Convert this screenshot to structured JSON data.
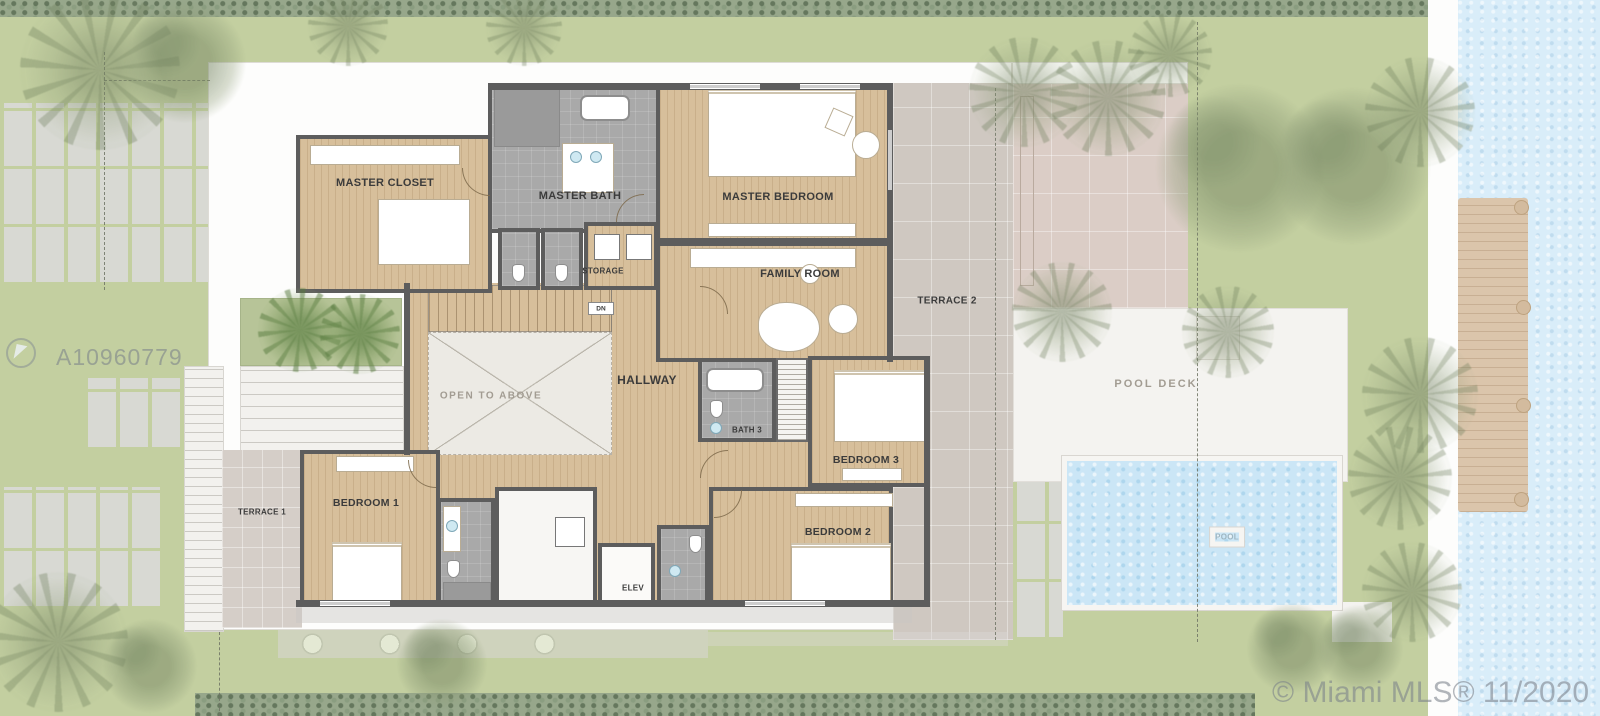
{
  "rooms": {
    "master_closet": "MASTER CLOSET",
    "master_bath": "MASTER BATH",
    "master_bedroom": "MASTER BEDROOM",
    "storage": "STORAGE",
    "family_room": "FAMILY ROOM",
    "terrace_2": "TERRACE 2",
    "hallway": "HALLWAY",
    "open_to_above": "OPEN TO ABOVE",
    "dn": "DN",
    "bath_3": "BATH 3",
    "bedroom_3": "BEDROOM 3",
    "bedroom_1": "BEDROOM 1",
    "terrace_1": "TERRACE 1",
    "bedroom_2": "BEDROOM 2",
    "elev": "ELEV",
    "pool_deck": "POOL DECK",
    "pool": "POOL"
  },
  "watermarks": {
    "listing_id": "A10960779",
    "mls_credit": "© Miami MLS® 11/2020"
  },
  "colors": {
    "grass": "#c3cfa0",
    "hedge": "#97a78b",
    "paver": "#d8d9d3",
    "wood": "#d7bf9b",
    "tile": "#a9a9a9",
    "wall": "#5d5d5d",
    "terrace": "#cfc8c1",
    "terrace_pink": "#dbcdc6",
    "terrace1": "#d5cec8",
    "pool_water": "#cbe6f6",
    "bay_water": "#d9edf9",
    "deck_white": "#f4f3f0",
    "dock_wood": "#dbc5ab",
    "white_roof": "#fdfdfc",
    "label_dark": "#3b3b3b",
    "label_muted": "#a29c92"
  },
  "landscape": {
    "trees": [
      {
        "type": "palm",
        "x": 100,
        "y": 70,
        "r": 80
      },
      {
        "type": "bush",
        "x": 185,
        "y": 62,
        "r": 62
      },
      {
        "type": "palm",
        "x": 348,
        "y": 26,
        "r": 40
      },
      {
        "type": "palm",
        "x": 524,
        "y": 28,
        "r": 38
      },
      {
        "type": "palm",
        "x": 1024,
        "y": 92,
        "r": 55
      },
      {
        "type": "palm",
        "x": 1108,
        "y": 98,
        "r": 58
      },
      {
        "type": "palm",
        "x": 1170,
        "y": 55,
        "r": 42
      },
      {
        "type": "bush",
        "x": 1240,
        "y": 168,
        "r": 86
      },
      {
        "type": "bush",
        "x": 1352,
        "y": 166,
        "r": 80
      },
      {
        "type": "palm",
        "x": 1420,
        "y": 112,
        "r": 55
      },
      {
        "type": "palm",
        "x": 1062,
        "y": 312,
        "r": 50
      },
      {
        "type": "palm",
        "x": 1228,
        "y": 332,
        "r": 46
      },
      {
        "type": "palm",
        "x": 1420,
        "y": 395,
        "r": 58
      },
      {
        "type": "palm",
        "x": 1400,
        "y": 478,
        "r": 52
      },
      {
        "type": "palm",
        "x": 1412,
        "y": 592,
        "r": 50
      },
      {
        "type": "bush",
        "x": 1292,
        "y": 648,
        "r": 46
      },
      {
        "type": "bush",
        "x": 1360,
        "y": 648,
        "r": 44
      },
      {
        "type": "palm",
        "x": 58,
        "y": 642,
        "r": 70
      },
      {
        "type": "bush",
        "x": 150,
        "y": 666,
        "r": 48
      },
      {
        "type": "bush",
        "x": 442,
        "y": 664,
        "r": 46
      },
      {
        "type": "palm",
        "x": 300,
        "y": 330,
        "r": 42,
        "variant": "green"
      },
      {
        "type": "palm",
        "x": 360,
        "y": 334,
        "r": 40,
        "variant": "green"
      }
    ]
  }
}
